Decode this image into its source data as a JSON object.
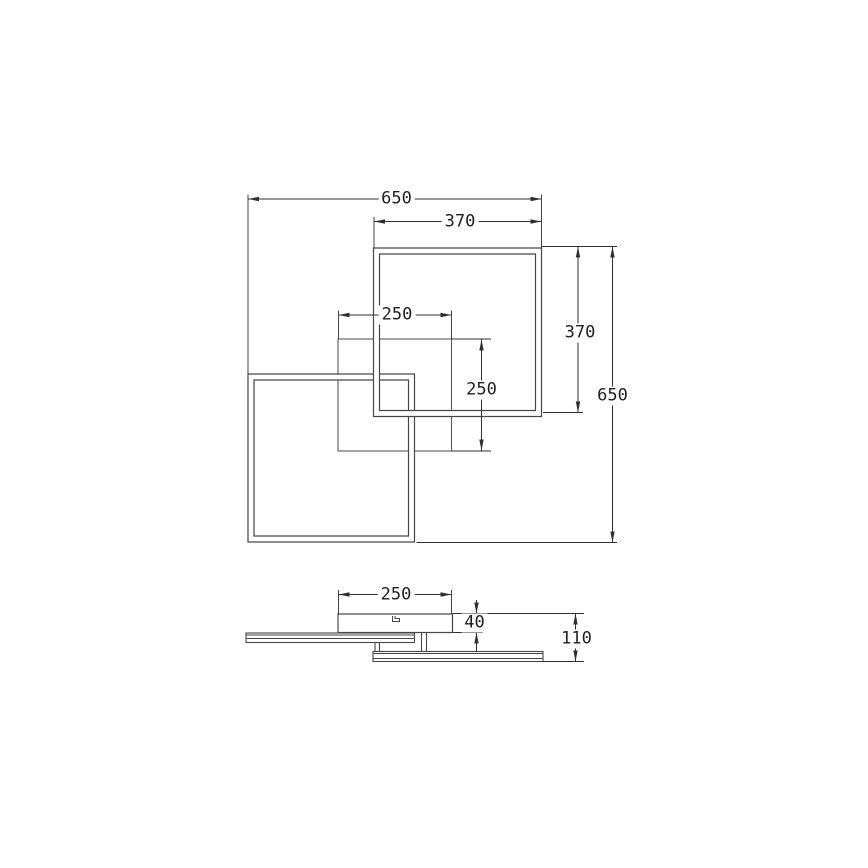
{
  "canvas": {
    "width": 868,
    "height": 868,
    "background": "#ffffff"
  },
  "style": {
    "frame_stroke": "#474747",
    "thin_stroke": "#5a5a5a",
    "dim_stroke": "#303030",
    "text_color": "#1f1f1f",
    "band_fill": "#ffffff"
  },
  "top_view": {
    "canopy_square": {
      "name": "canopy-outline-250",
      "x": 338,
      "y": 339,
      "w": 113.5,
      "h": 112
    },
    "frames": [
      {
        "name": "frame-lower-left",
        "x": 248,
        "y": 374,
        "w": 166.5,
        "h": 168,
        "inset": 6
      },
      {
        "name": "frame-upper-right",
        "x": 373.5,
        "y": 248,
        "w": 168,
        "h": 168.5,
        "inset": 6
      }
    ]
  },
  "side_view": {
    "canopy_box": {
      "name": "canopy-profile",
      "x": 338,
      "y": 614,
      "w": 114.5,
      "h": 18.5
    },
    "clip_detail": [
      [
        392.5,
        616
      ],
      [
        392.5,
        621.5
      ],
      [
        399.5,
        621.5
      ],
      [
        399.5,
        618.5
      ],
      [
        395,
        618.5
      ],
      [
        395,
        616
      ]
    ],
    "plates": [
      {
        "name": "left-frame-profile",
        "x": 246,
        "y": 633,
        "w": 168.5,
        "h": 9.5,
        "inner_lines": [
          635,
          638.5
        ]
      },
      {
        "name": "right-frame-profile",
        "x": 373,
        "y": 651.5,
        "w": 170,
        "h": 10,
        "inner_lines": [
          653.5,
          658.5
        ]
      }
    ],
    "stems": [
      {
        "name": "stem-center",
        "x": 421.5,
        "y": 632.5,
        "w": 5,
        "h": 19
      },
      {
        "name": "stem-left",
        "x": 375,
        "y": 642.5,
        "w": 4.5,
        "h": 9
      }
    ]
  },
  "dimensions": [
    {
      "name": "overall-width",
      "label": "650",
      "lines": [
        [
          248,
          199,
          541.5,
          199
        ]
      ],
      "arrows": [
        [
          248,
          199,
          "left"
        ],
        [
          541.5,
          199,
          "right"
        ]
      ],
      "exts": [
        [
          248,
          194.5,
          248,
          374
        ],
        [
          541.5,
          194.5,
          541.5,
          248
        ]
      ],
      "label_pos": [
        396.5,
        199
      ]
    },
    {
      "name": "upper-frame-width",
      "label": "370",
      "lines": [
        [
          374,
          221.5,
          541.5,
          221.5
        ]
      ],
      "arrows": [
        [
          374,
          221.5,
          "left"
        ],
        [
          541.5,
          221.5,
          "right"
        ]
      ],
      "exts": [
        [
          374,
          217,
          374,
          248
        ]
      ],
      "label_pos": [
        460,
        221.5
      ]
    },
    {
      "name": "canopy-width",
      "label": "250",
      "lines": [
        [
          338.5,
          315,
          451.5,
          315
        ]
      ],
      "arrows": [
        [
          338.5,
          315,
          "left"
        ],
        [
          451.5,
          315,
          "right"
        ]
      ],
      "exts": [
        [
          338.5,
          310.5,
          338.5,
          339
        ],
        [
          451.5,
          310.5,
          451.5,
          339
        ]
      ],
      "label_pos": [
        397,
        315
      ]
    },
    {
      "name": "canopy-depth",
      "label": "250",
      "lines": [
        [
          481.5,
          339.5,
          481.5,
          450.5
        ]
      ],
      "arrows": [
        [
          481.5,
          339.5,
          "up"
        ],
        [
          481.5,
          450.5,
          "down"
        ]
      ],
      "exts": [
        [
          452,
          339,
          491,
          339
        ],
        [
          452,
          451,
          491,
          451
        ]
      ],
      "label_pos": [
        481.5,
        389.5
      ]
    },
    {
      "name": "upper-frame-depth",
      "label": "370",
      "lines": [
        [
          578,
          246.5,
          578,
          412.5
        ]
      ],
      "arrows": [
        [
          578,
          246.5,
          "up"
        ],
        [
          578,
          412.5,
          "down"
        ]
      ],
      "exts": [
        [
          543,
          412.5,
          583,
          412.5
        ]
      ],
      "label_pos": [
        580,
        332.5
      ]
    },
    {
      "name": "overall-depth",
      "label": "650",
      "lines": [
        [
          612.5,
          246.5,
          612.5,
          542.5
        ]
      ],
      "arrows": [
        [
          612.5,
          246.5,
          "up"
        ],
        [
          612.5,
          542.5,
          "down"
        ]
      ],
      "exts": [
        [
          541.5,
          246.5,
          617,
          246.5
        ],
        [
          416.5,
          542.5,
          617,
          542.5
        ]
      ],
      "label_pos": [
        612.5,
        395.5
      ]
    },
    {
      "name": "canopy-width-side",
      "label": "250",
      "lines": [
        [
          338.5,
          594.5,
          451.5,
          594.5
        ]
      ],
      "arrows": [
        [
          338.5,
          594.5,
          "left"
        ],
        [
          451.5,
          594.5,
          "right"
        ]
      ],
      "exts": [
        [
          338.5,
          590,
          338.5,
          614
        ],
        [
          451.5,
          590,
          451.5,
          614
        ]
      ],
      "label_pos": [
        396,
        594.5
      ]
    },
    {
      "name": "canopy-height",
      "label": "40",
      "lines": [
        [
          476.5,
          600,
          476.5,
          613.5
        ],
        [
          476.5,
          632.5,
          476.5,
          652
        ]
      ],
      "arrows": [
        [
          476.5,
          613.5,
          "down"
        ],
        [
          476.5,
          632.5,
          "up"
        ]
      ],
      "exts": [
        [
          452.5,
          632.5,
          483,
          632.5
        ]
      ],
      "label_pos": [
        474.5,
        622.5
      ]
    },
    {
      "name": "overall-height",
      "label": "110",
      "lines": [
        [
          575.5,
          613.5,
          575.5,
          661.5
        ]
      ],
      "arrows": [
        [
          575.5,
          613.5,
          "up"
        ],
        [
          575.5,
          661.5,
          "down"
        ]
      ],
      "exts": [
        [
          452.5,
          613.5,
          584,
          613.5
        ],
        [
          543,
          661.5,
          584,
          661.5
        ]
      ],
      "label_pos": [
        576.5,
        639
      ]
    }
  ]
}
